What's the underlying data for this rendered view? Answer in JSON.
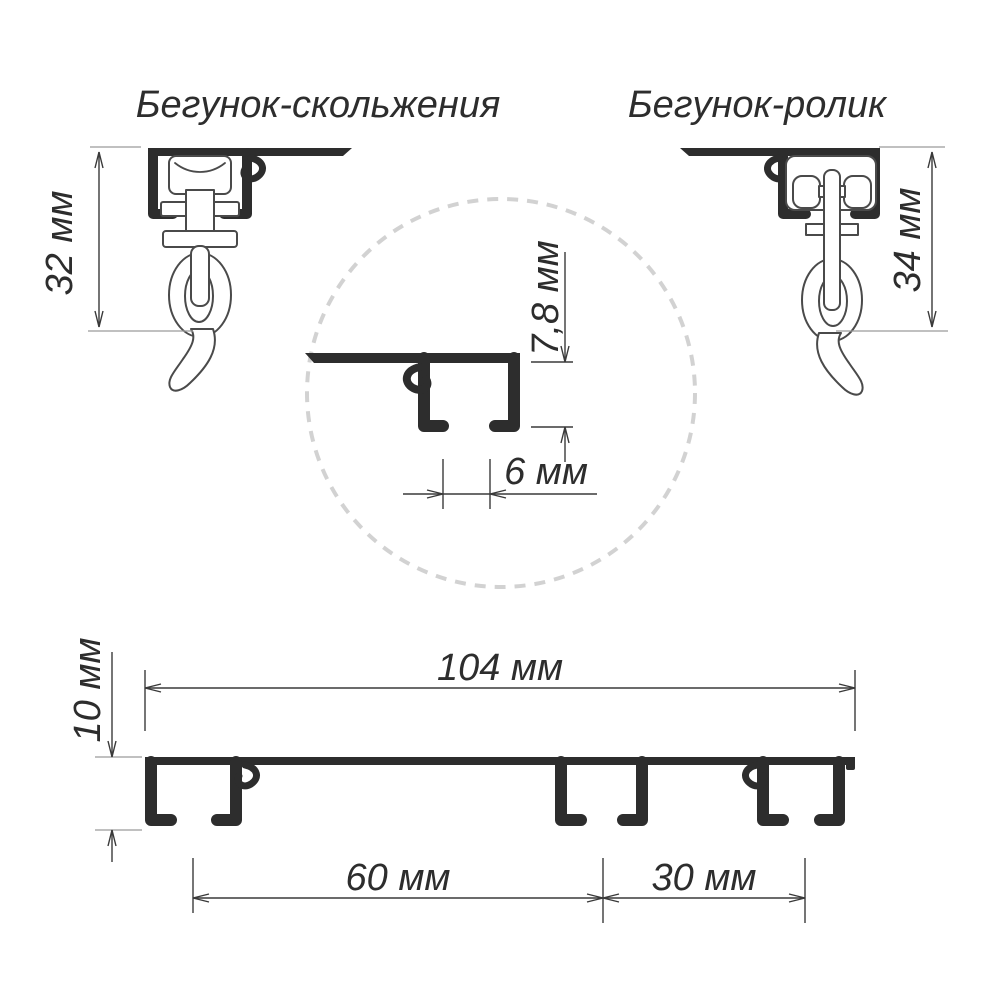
{
  "titles": {
    "left": "Бегунок-скольжения",
    "right": "Бегунок-ролик"
  },
  "dimensions": {
    "slide_runner_height": "32 мм",
    "roller_runner_height": "34 мм",
    "rail_channel_depth": "7,8 мм",
    "rail_slot_width": "6 мм",
    "profile_height": "10 мм",
    "profile_width": "104 мм",
    "groove_spacing_wide": "60 мм",
    "groove_spacing_narrow": "30 мм"
  },
  "colors": {
    "ink": "#2d2d2d",
    "part_outline": "#4a4a4a",
    "dimension_line": "#3a3a3a",
    "extension_line": "#9a9a9a",
    "detail_circle_dash": "#d2d2d2",
    "background": "#ffffff"
  }
}
